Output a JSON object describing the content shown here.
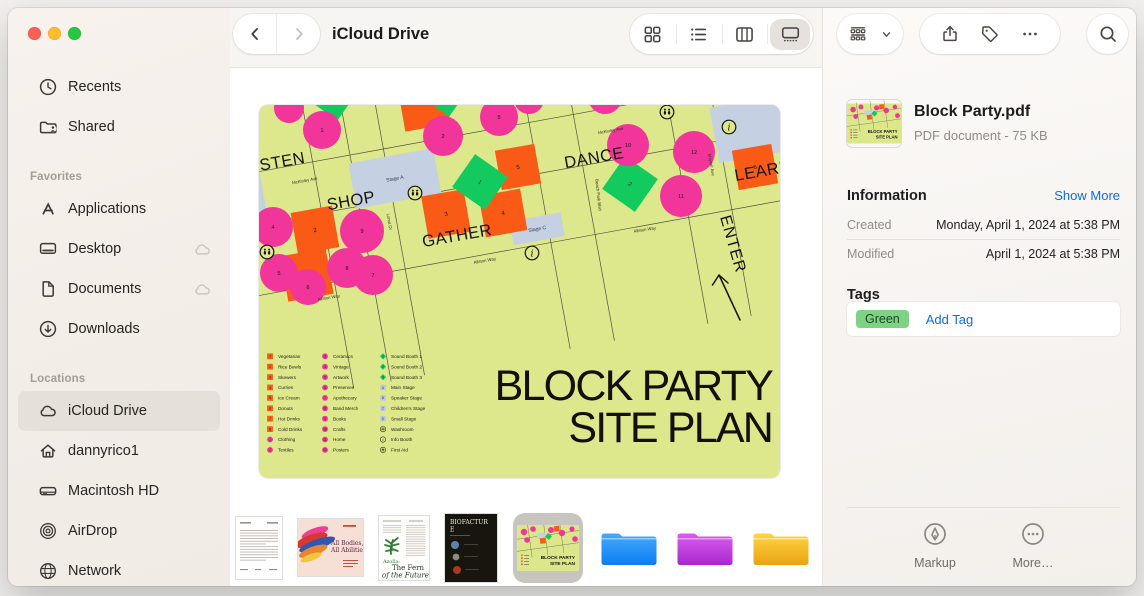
{
  "window": {
    "traffic_colors": [
      "#ff5e57",
      "#febb2e",
      "#28c73f"
    ]
  },
  "toolbar": {
    "title": "iCloud Drive",
    "views": [
      {
        "id": "icons",
        "icon": "view-grid",
        "selected": false
      },
      {
        "id": "list",
        "icon": "view-list",
        "selected": false
      },
      {
        "id": "columns",
        "icon": "view-columns",
        "selected": false
      },
      {
        "id": "gallery",
        "icon": "view-gallery",
        "selected": true
      }
    ]
  },
  "sidebar": {
    "top_items": [
      {
        "id": "recents",
        "icon": "clock",
        "label": "Recents"
      },
      {
        "id": "shared",
        "icon": "shared-folder",
        "label": "Shared"
      }
    ],
    "sections": [
      {
        "id": "favorites",
        "header": "Favorites",
        "items": [
          {
            "id": "applications",
            "icon": "appstore",
            "label": "Applications"
          },
          {
            "id": "desktop",
            "icon": "display",
            "label": "Desktop",
            "badge": "cloud"
          },
          {
            "id": "documents",
            "icon": "document",
            "label": "Documents",
            "badge": "cloud"
          },
          {
            "id": "downloads",
            "icon": "download",
            "label": "Downloads"
          }
        ]
      },
      {
        "id": "locations",
        "header": "Locations",
        "items": [
          {
            "id": "icloud-drive",
            "icon": "cloud",
            "label": "iCloud Drive",
            "selected": true
          },
          {
            "id": "dannyrico1",
            "icon": "home",
            "label": "dannyrico1"
          },
          {
            "id": "macintosh-hd",
            "icon": "harddrive",
            "label": "Macintosh HD"
          },
          {
            "id": "airdrop",
            "icon": "airdrop",
            "label": "AirDrop"
          },
          {
            "id": "network",
            "icon": "globe",
            "label": "Network"
          }
        ]
      }
    ]
  },
  "map": {
    "bg": "#dde78c",
    "colors": {
      "pink": "#f1359a",
      "orange": "#f95b16",
      "green": "#12ca5d",
      "stage": "#c5d1e3",
      "line": "#45413a"
    },
    "title": [
      "BLOCK PARTY",
      "SITE PLAN"
    ],
    "zones": [
      {
        "label": "LISTEN",
        "x": 17,
        "y": 63,
        "rot": -10
      },
      {
        "label": "SHOP",
        "x": 93,
        "y": 101,
        "rot": -10
      },
      {
        "label": "GATHER",
        "x": 199,
        "y": 136,
        "rot": -10
      },
      {
        "label": "DANCE",
        "x": 336,
        "y": 58,
        "rot": -10
      },
      {
        "label": "LEARN",
        "x": 505,
        "y": 71,
        "rot": -10
      }
    ],
    "enter": {
      "label": "ENTER",
      "x": 461,
      "y": 112,
      "rot": 74
    },
    "streets": {
      "h": [
        22,
        74,
        144
      ],
      "v": [
        80,
        118,
        152,
        300,
        345,
        440,
        484
      ]
    },
    "street_labels": [
      {
        "t": "McKinley Ave",
        "x": 46,
        "y": 77,
        "r": -10
      },
      {
        "t": "McKinley Ave",
        "x": 352,
        "y": 27,
        "r": -10
      },
      {
        "t": "Loma Dr",
        "x": 129,
        "y": 117,
        "r": 80
      },
      {
        "t": "Beach Park Blvd",
        "x": 338,
        "y": 90,
        "r": 84
      },
      {
        "t": "Mayfair Ave",
        "x": 451,
        "y": 60,
        "r": 80
      },
      {
        "t": "Allston Way",
        "x": 226,
        "y": 157,
        "r": -10
      },
      {
        "t": "Allston Way",
        "x": 386,
        "y": 126,
        "r": -9
      },
      {
        "t": "Allston Way",
        "x": 70,
        "y": 194,
        "r": -10
      }
    ],
    "stages": [
      {
        "x": 115,
        "y": 30,
        "w": 86,
        "h": 46,
        "label": "Stage A"
      },
      {
        "x": 263,
        "y": 116,
        "w": 52,
        "h": 24,
        "label": "Stage C"
      },
      {
        "x": -22,
        "y": 22,
        "w": 48,
        "h": 50,
        "label": ""
      },
      {
        "x": 480,
        "y": 40,
        "w": 72,
        "h": 56,
        "label": ""
      }
    ],
    "squares": [
      [
        56,
        125,
        42,
        "2"
      ],
      [
        48,
        170,
        46,
        "1"
      ],
      [
        187,
        109,
        43,
        "3"
      ],
      [
        244,
        108,
        42,
        "4"
      ],
      [
        259,
        62,
        40,
        "5"
      ],
      [
        496,
        62,
        40,
        "6"
      ],
      [
        165,
        0,
        46,
        ""
      ]
    ],
    "circles": [
      [
        63,
        25,
        19,
        "1"
      ],
      [
        30,
        3,
        15,
        ""
      ],
      [
        184,
        31,
        20,
        "2"
      ],
      [
        240,
        12,
        19,
        "5"
      ],
      [
        270,
        -6,
        15,
        ""
      ],
      [
        346,
        -8,
        17,
        ""
      ],
      [
        369,
        40,
        21,
        "10"
      ],
      [
        435,
        47,
        21,
        "12"
      ],
      [
        422,
        91,
        21,
        "11"
      ],
      [
        14,
        122,
        20,
        "4"
      ],
      [
        103,
        126,
        22,
        "9"
      ],
      [
        88,
        163,
        20,
        "8"
      ],
      [
        20,
        168,
        19,
        "5"
      ],
      [
        49,
        182,
        18,
        "6"
      ],
      [
        114,
        170,
        20,
        "7"
      ]
    ],
    "diamonds": [
      [
        221,
        77,
        40,
        "1"
      ],
      [
        371,
        79,
        40,
        "2"
      ],
      [
        186,
        -12,
        34,
        ""
      ],
      [
        340,
        -14,
        34,
        ""
      ],
      [
        75,
        -4,
        28,
        ""
      ]
    ],
    "markers": [
      {
        "t": "wc",
        "x": 156,
        "y": 88
      },
      {
        "t": "wc",
        "x": 8,
        "y": 147
      },
      {
        "t": "wc",
        "x": 408,
        "y": 7
      },
      {
        "t": "info",
        "x": 273,
        "y": 148
      },
      {
        "t": "info",
        "x": 470,
        "y": 22
      }
    ],
    "legend": {
      "columns": [
        {
          "items": [
            {
              "i": "sq",
              "n": "1",
              "t": "Vegetarian"
            },
            {
              "i": "sq",
              "n": "2",
              "t": "Rice Bowls"
            },
            {
              "i": "sq",
              "n": "3",
              "t": "Skewers"
            },
            {
              "i": "sq",
              "n": "4",
              "t": "Curries"
            },
            {
              "i": "sq",
              "n": "5",
              "t": "Ice Cream"
            },
            {
              "i": "sq",
              "n": "6",
              "t": "Donuts"
            },
            {
              "i": "sq",
              "n": "7",
              "t": "Hot Drinks"
            },
            {
              "i": "sq",
              "n": "8",
              "t": "Cold Drinks"
            },
            {
              "i": "ci",
              "n": "1",
              "t": "Clothing"
            },
            {
              "i": "ci",
              "n": "2",
              "t": "Textiles"
            }
          ]
        },
        {
          "items": [
            {
              "i": "ci",
              "n": "3",
              "t": "Ceramics"
            },
            {
              "i": "ci",
              "n": "4",
              "t": "Vintage"
            },
            {
              "i": "ci",
              "n": "5",
              "t": "Artwork"
            },
            {
              "i": "ci",
              "n": "6",
              "t": "Preserves"
            },
            {
              "i": "ci",
              "n": "7",
              "t": "Apothecary"
            },
            {
              "i": "ci",
              "n": "8",
              "t": "Band Merch"
            },
            {
              "i": "ci",
              "n": "9",
              "t": "Books"
            },
            {
              "i": "ci",
              "n": "10",
              "t": "Crafts"
            },
            {
              "i": "ci",
              "n": "11",
              "t": "Home"
            },
            {
              "i": "ci",
              "n": "12",
              "t": "Posters"
            }
          ]
        },
        {
          "items": [
            {
              "i": "di",
              "n": "1",
              "t": "Sound Booth 1"
            },
            {
              "i": "di",
              "n": "2",
              "t": "Sound Booth 2"
            },
            {
              "i": "di",
              "n": "3",
              "t": "Sound Booth 3"
            },
            {
              "i": "st",
              "n": "A",
              "t": "Main Stage"
            },
            {
              "i": "st",
              "n": "B",
              "t": "Speaker Stage"
            },
            {
              "i": "st",
              "n": "C",
              "t": "Children's Stage"
            },
            {
              "i": "st",
              "n": "D",
              "t": "Small Stage"
            },
            {
              "i": "wc",
              "n": "",
              "t": "Washroom"
            },
            {
              "i": "info",
              "n": "",
              "t": "Info Booth"
            },
            {
              "i": "aid",
              "n": "",
              "t": "First Aid"
            }
          ]
        }
      ]
    }
  },
  "gallery_items": [
    {
      "id": "letter-doc",
      "type": "doc-text"
    },
    {
      "id": "poster-doc",
      "type": "doc-poster",
      "title_lines": [
        "All Bodies,",
        "All Abilities"
      ]
    },
    {
      "id": "fern-doc",
      "type": "doc-fern",
      "accent": "Azolla:",
      "title_lines": [
        "The Fern",
        "of the Future"
      ]
    },
    {
      "id": "biofacture-doc",
      "type": "doc-dark",
      "title_lines": [
        "BIOFACTUR",
        "E"
      ]
    },
    {
      "id": "block-party-pdf",
      "type": "siteplan",
      "selected": true
    },
    {
      "id": "folder-blue",
      "type": "folder",
      "c1": "#45aafd",
      "c2": "#0d7df1"
    },
    {
      "id": "folder-purple",
      "type": "folder",
      "c1": "#da5df2",
      "c2": "#aa28cb"
    },
    {
      "id": "folder-yellow",
      "type": "folder",
      "c1": "#ffd445",
      "c2": "#e9a411"
    }
  ],
  "inspector": {
    "file": {
      "name": "Block Party.pdf",
      "meta": "PDF document - 75 KB"
    },
    "information": {
      "header": "Information",
      "show_more": "Show More",
      "rows": [
        {
          "label": "Created",
          "value": "Monday, April 1, 2024 at 5:38 PM"
        },
        {
          "label": "Modified",
          "value": "April 1, 2024 at 5:38 PM"
        }
      ]
    },
    "tags": {
      "header": "Tags",
      "tags": [
        {
          "label": "Green",
          "bg": "#7fd186",
          "fg": "#1c4a1e"
        }
      ],
      "add_label": "Add Tag"
    },
    "actions": [
      {
        "id": "markup",
        "icon": "markup",
        "label": "Markup"
      },
      {
        "id": "more",
        "icon": "more-circle",
        "label": "More…"
      }
    ]
  }
}
